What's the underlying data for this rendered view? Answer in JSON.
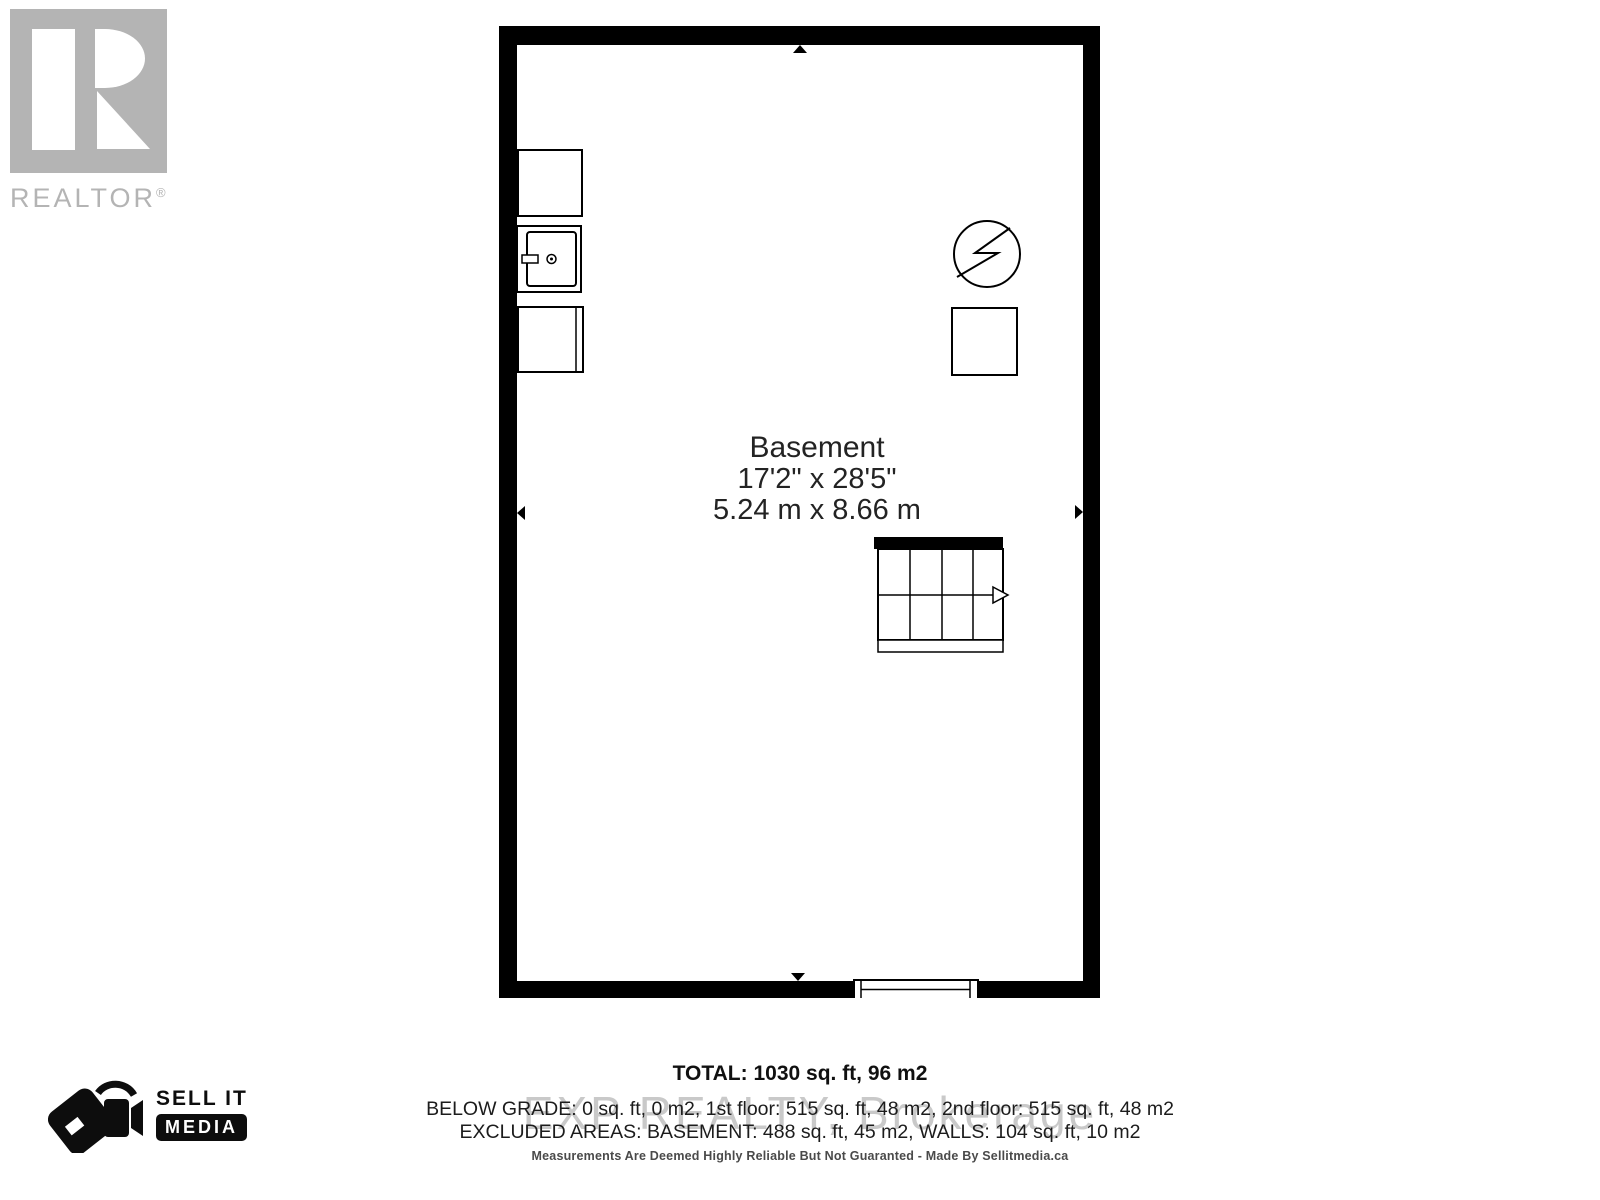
{
  "branding": {
    "realtor": {
      "word": "REALTOR",
      "reg": "®"
    },
    "sellit": {
      "line1": "SELL IT",
      "line2": "MEDIA"
    }
  },
  "plan": {
    "room": {
      "name": "Basement",
      "imperial": "17'2\" x 28'5\"",
      "metric": "5.24 m x 8.66 m"
    }
  },
  "summary": {
    "total": "TOTAL: 1030 sq. ft, 96 m2",
    "below_grade": "BELOW GRADE: 0 sq. ft, 0 m2, 1st floor: 515 sq. ft, 48 m2, 2nd floor: 515 sq. ft, 48 m2",
    "excluded": "EXCLUDED AREAS: BASEMENT: 488 sq. ft, 45 m2, WALLS: 104 sq. ft, 10 m2"
  },
  "watermark": "EXP REALTY, Brokerage",
  "disclaimer": "Measurements Are Deemed Highly Reliable But Not Guaranted - Made By Sellitmedia.ca",
  "icons": {
    "realtor_r_icon": "gray block with white stylized R",
    "sellit_tag_camera_icon": "price tag with video camera",
    "washer_icon": "top-view washing machine with door and knob",
    "cabinet_top_icon": "plain square fixture",
    "cabinet_bottom_icon": "square fixture with door line",
    "electrical_icon": "circle with lightning bolt",
    "utility_square_icon": "square fixture",
    "stairs_icon": "staircase grid with direction arrow",
    "window_icon": "window opening in bottom wall",
    "dimension_arrow_icon": "small black triangle extent markers"
  },
  "colors": {
    "wall": "#000000",
    "logo_gray": "#b4b4b4",
    "text_dark": "#1f1f1f",
    "watermark_gray": "#c9c9c9",
    "disclaimer_gray": "#4a4a4a"
  }
}
